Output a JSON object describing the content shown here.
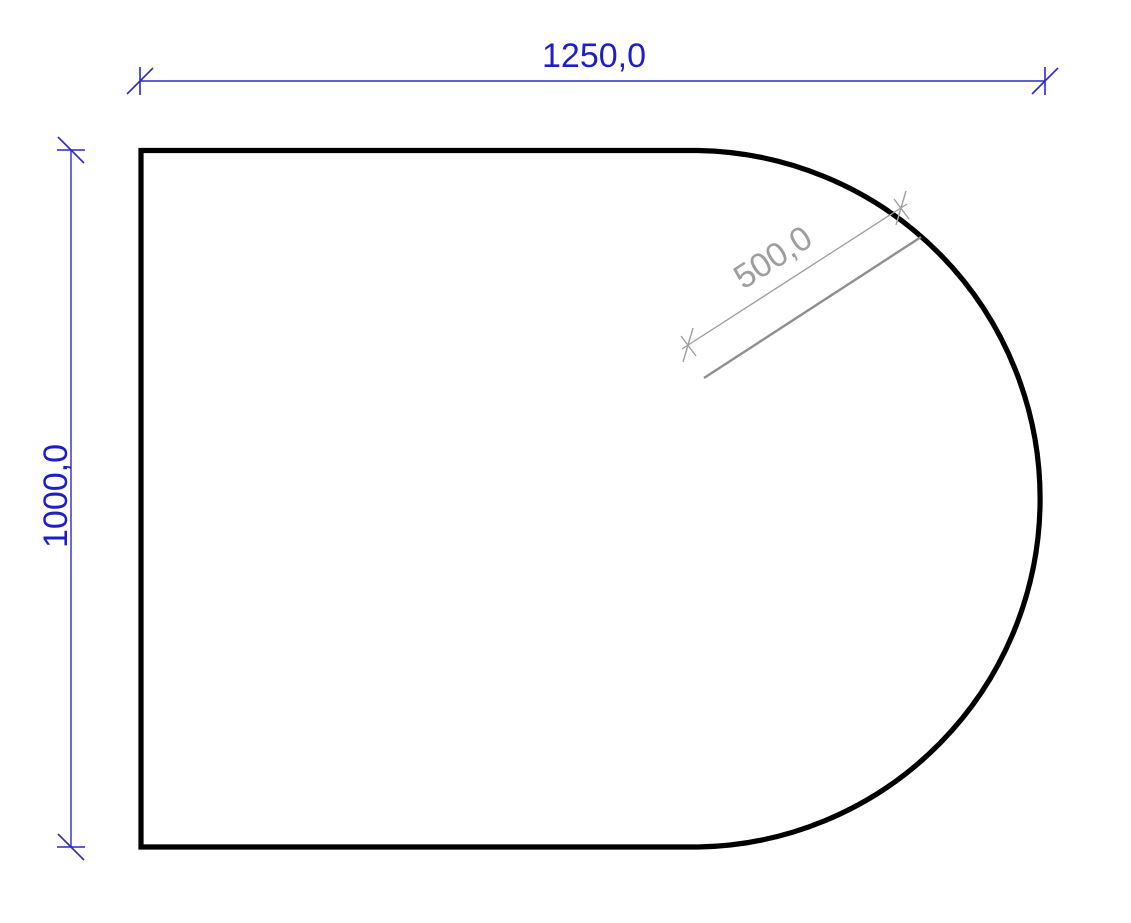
{
  "drawing": {
    "description": "Technical drawing preview of a plate: rectangle with semicircular right end",
    "shape": "rectangle-with-semicircular-right-side",
    "decimal_separator": ",",
    "dimensions": {
      "width": {
        "label": "1250,0",
        "value": 1250.0
      },
      "height": {
        "label": "1000,0",
        "value": 1000.0
      },
      "radius": {
        "label": "500,0",
        "value": 500.0
      }
    },
    "colors": {
      "outline": "#000000",
      "primary_dimension": "#2222c8",
      "secondary_dimension": "#9e9e9e",
      "background": "#ffffff"
    }
  }
}
